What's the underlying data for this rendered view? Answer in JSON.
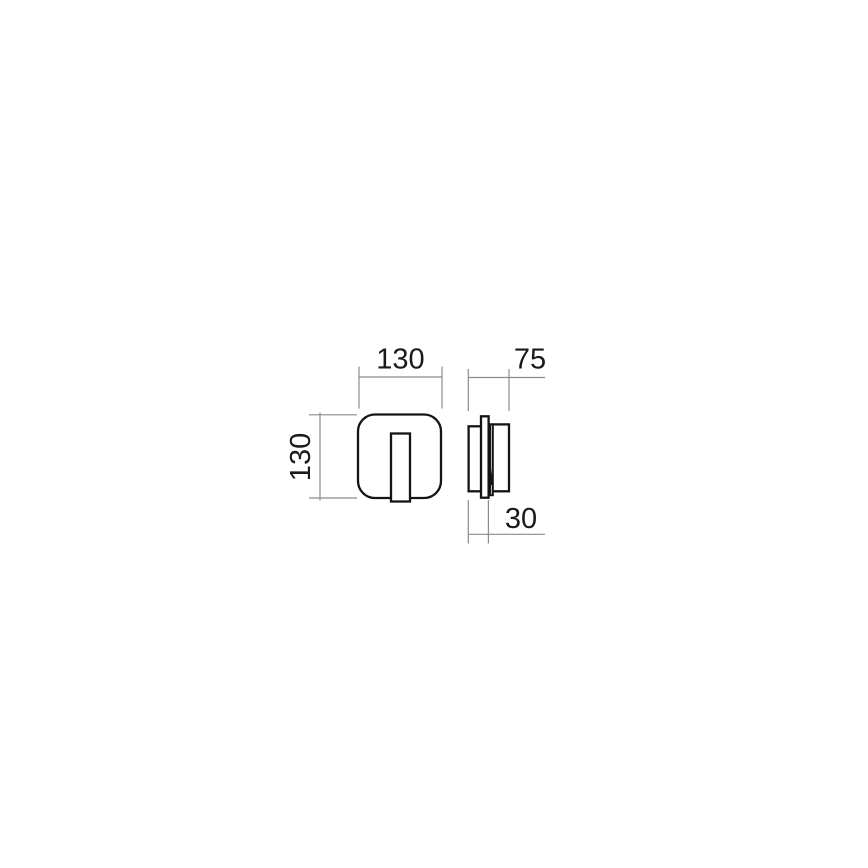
{
  "drawing": {
    "labels": {
      "front_width": "130",
      "front_height": "130",
      "side_total_depth": "75",
      "side_mount_depth": "30"
    },
    "colors": {
      "object_line": "#141414",
      "dimension_line": "#8c8c8c",
      "label_text": "#1a1a1a",
      "background": "#ffffff"
    }
  }
}
